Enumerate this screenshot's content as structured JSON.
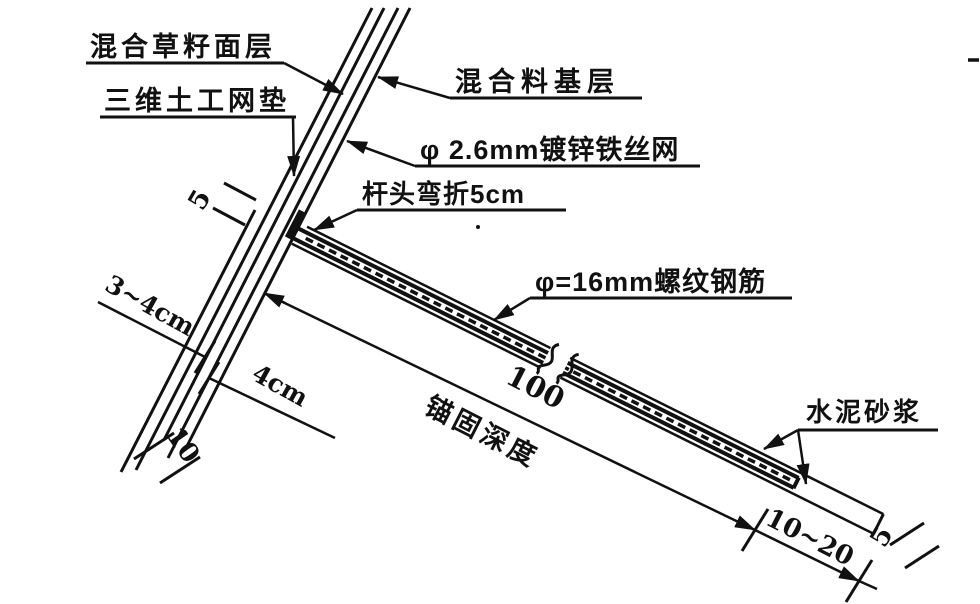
{
  "diagram": {
    "type": "engineering-section-detail",
    "colors": {
      "line": "#111111",
      "background": "#ffffff"
    },
    "labels": {
      "grass_surface_layer": "混合草籽面层",
      "geomat_layer": "三维土工网垫",
      "base_layer": "混合料基层",
      "wire_mesh": "φ 2.6mm镀锌铁丝网",
      "bent_head": "杆头弯折5cm",
      "rebar": "φ=16mm螺纹钢筋",
      "mortar": "水泥砂浆",
      "anchor_depth": "锚固深度"
    },
    "dimensions": {
      "head_bend_length": "5",
      "surface_thickness": "3~4cm",
      "base_thickness": "4cm",
      "total_layer_thickness": "10",
      "anchor_length": "100",
      "mortar_plug_length": "10~20",
      "end_cover": "5"
    }
  }
}
